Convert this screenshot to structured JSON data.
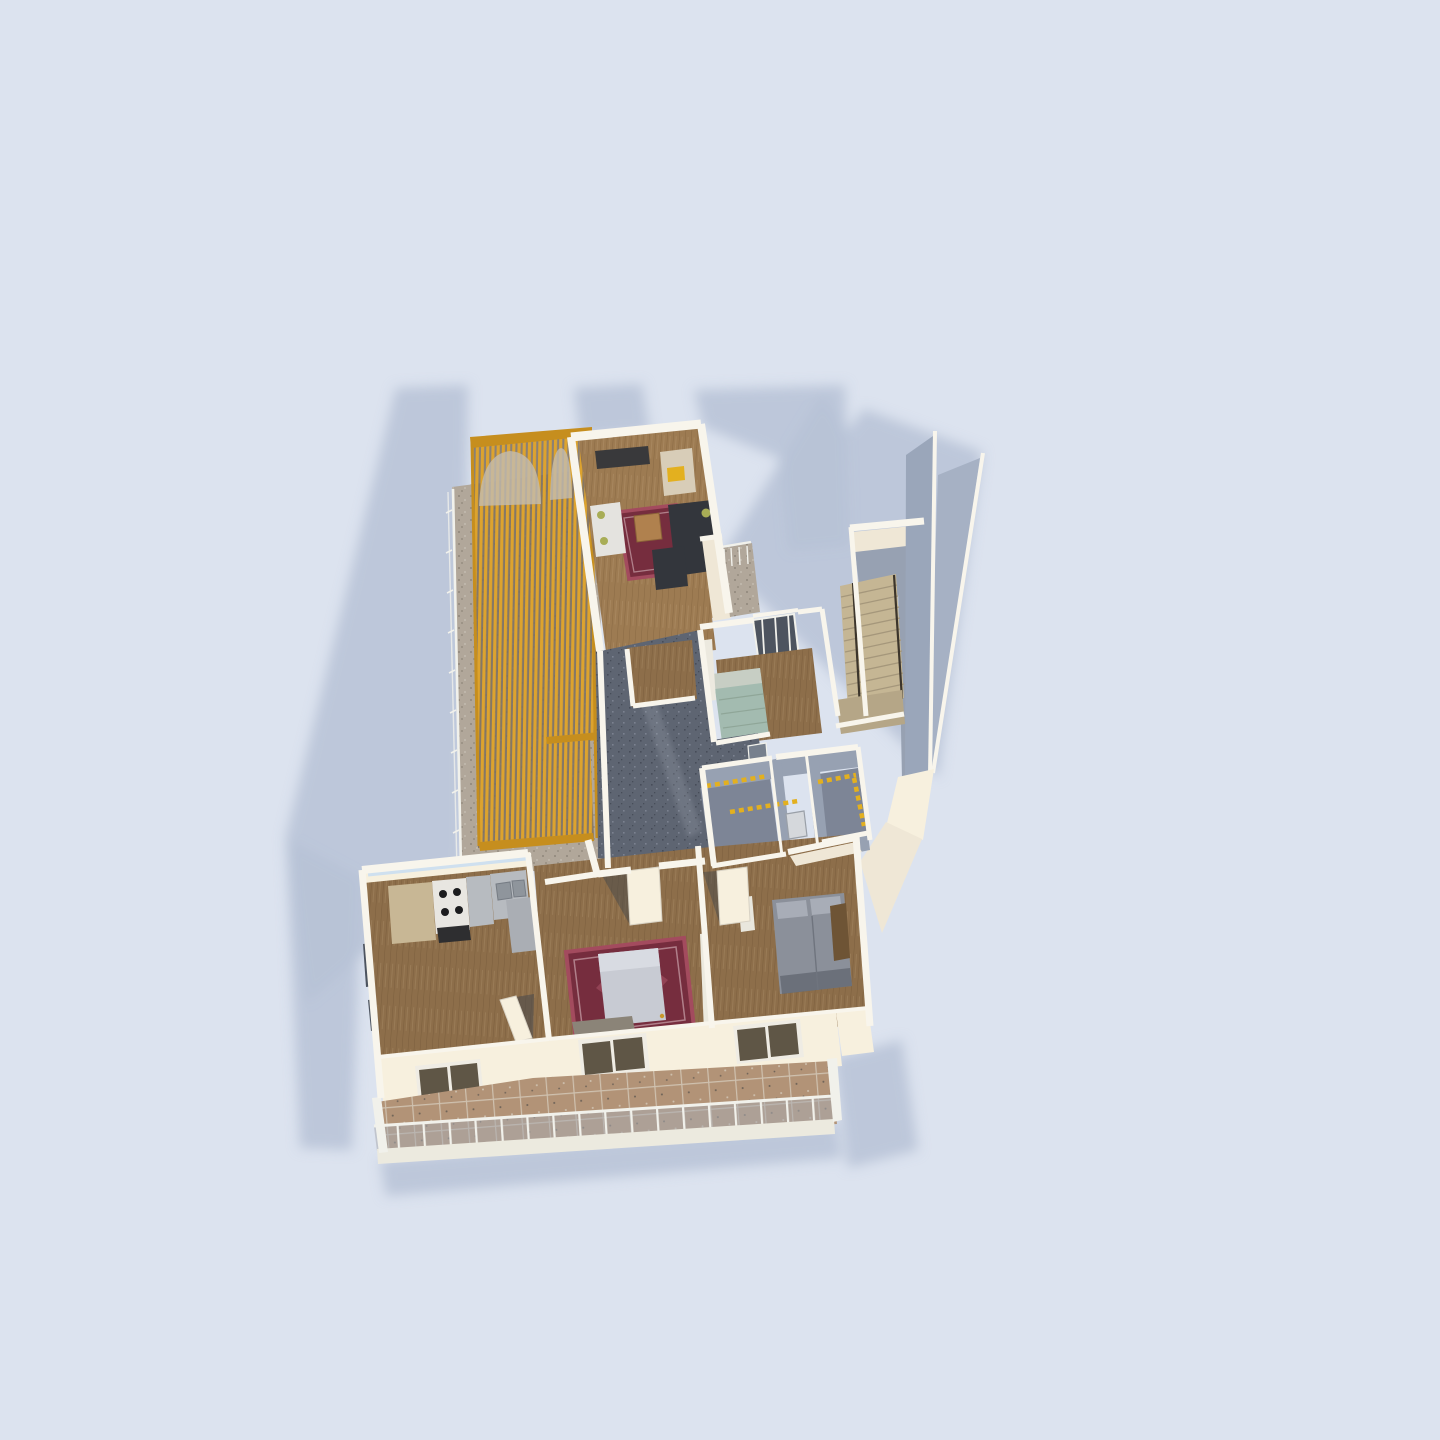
{
  "app": {
    "title": "3D Apartment Floor Plan Render",
    "view": "overhead perspective render",
    "background_color": "#dce3ef"
  },
  "palette": {
    "background": "#dce3ef",
    "shadow": "#b7c2d6",
    "wallTop": "#f8f5ec",
    "wallBright": "#f7f0de",
    "wallCream": "#efe7d6",
    "wallGrayA": "#9aa6ba",
    "wallGrayB": "#97a1b2",
    "wallGrayC": "#a6b1c4",
    "woodA": "#9d7b52",
    "woodB": "#8d6e4a",
    "granite": "#5e6572",
    "graniteDot1": "#474d59",
    "graniteDot2": "#7b8290",
    "gravel": "#b1a79a",
    "gravelDot": "#8f867a",
    "gravelLight": "#c3bbb0",
    "tileBase": "#b29377",
    "tileGrout": "#cfc1af",
    "tileDot": "#6e6257",
    "pergola": "#dda32e",
    "pergolaFrame": "#c68e1e",
    "pergolaDark": "#7c6f5e",
    "rugRed": "#762d3e",
    "rugBorder": "#a34b5e",
    "rugLight": "#c9a2ab",
    "sofaDark": "#33363c",
    "pillowGreen": "#a8ad56",
    "chairWhite": "#e4e3df",
    "tableWood": "#b0814e",
    "tvDark": "#39393b",
    "bedWhite": "#c8cbd3",
    "bedGray": "#8b909a",
    "pillowGray": "#a8adb7",
    "bedFootDark": "#565b66",
    "bedTeal": "#a3bbb0",
    "pillowTeal": "#c7cec4",
    "stairBeige": "#c5b694",
    "stairLine": "#a5977b",
    "stairDark": "#b5a687",
    "railDark": "#3c352b",
    "bathFloor": "#7d8596",
    "accentYellow": "#e3b01f",
    "toilet": "#d5d8dc",
    "cabinet": "#c8b795",
    "stoveWhite": "#e8e6e1",
    "stoveFront": "#2e2e30",
    "counter": "#b7bbc0",
    "counterDark": "#aaaeb4",
    "burner": "#1c1c1e",
    "sinkBasin": "#8f959c",
    "glassDark": "#5f5646",
    "windowDark": "#4d545f",
    "skylight": "#cfe0ef",
    "railWhite": "#f1f1eb",
    "mesh": "#a9abb0",
    "fascia": "#eceadf",
    "navy": "#3d4455",
    "doorBrown": "#6e5435",
    "doorGray": "#77808d",
    "gapDark": "#3f444c"
  },
  "scene": {
    "type": "3d-floorplan",
    "rooms": [
      {
        "id": "balcony-west-pergola",
        "floor": "gravel",
        "features": [
          "wood-slat-pergola",
          "railing",
          "arched-slat-screen"
        ]
      },
      {
        "id": "living-room",
        "floor": "wood",
        "furniture": [
          "wall-tv",
          "media-shelf",
          "white-armchair",
          "dark-sectional-sofa",
          "coffee-table",
          "oriental-rug"
        ]
      },
      {
        "id": "light-well",
        "floor": "gravel",
        "features": [
          "railing",
          "barred-windows"
        ]
      },
      {
        "id": "stairwell",
        "floor": "stairs",
        "features": [
          "tall-gray-wall-slabs",
          "landing"
        ]
      },
      {
        "id": "guest-room",
        "floor": "wood",
        "furniture": [
          "single-bed-teal",
          "closet"
        ]
      },
      {
        "id": "hallway",
        "floor": "granite",
        "features": [
          "wood-alcove"
        ]
      },
      {
        "id": "bathroom",
        "floor": "gray-tile",
        "furniture": [
          "toilet"
        ],
        "features": [
          "yellow-mosaic-band"
        ]
      },
      {
        "id": "wc",
        "floor": "gray-tile",
        "features": [
          "yellow-mosaic-band"
        ]
      },
      {
        "id": "kitchen",
        "floor": "wood",
        "furniture": [
          "tall-cabinet",
          "stove-4-burners",
          "double-sink",
          "counters"
        ],
        "features": [
          "skylight-strip",
          "west-windows",
          "open-door"
        ]
      },
      {
        "id": "bedroom-middle",
        "floor": "wood",
        "furniture": [
          "double-bed-white",
          "oriental-rug",
          "bench",
          "wardrobe"
        ],
        "features": [
          "open-door"
        ]
      },
      {
        "id": "bedroom-right",
        "floor": "wood",
        "furniture": [
          "double-bed-gray",
          "nightstand",
          "wardrobe"
        ],
        "features": [
          "open-door",
          "brown-door"
        ]
      },
      {
        "id": "balcony-south",
        "floor": "brown-tile",
        "features": [
          "railing-with-posts",
          "sliding-glass-doors-x3",
          "white-fascia"
        ]
      }
    ]
  }
}
